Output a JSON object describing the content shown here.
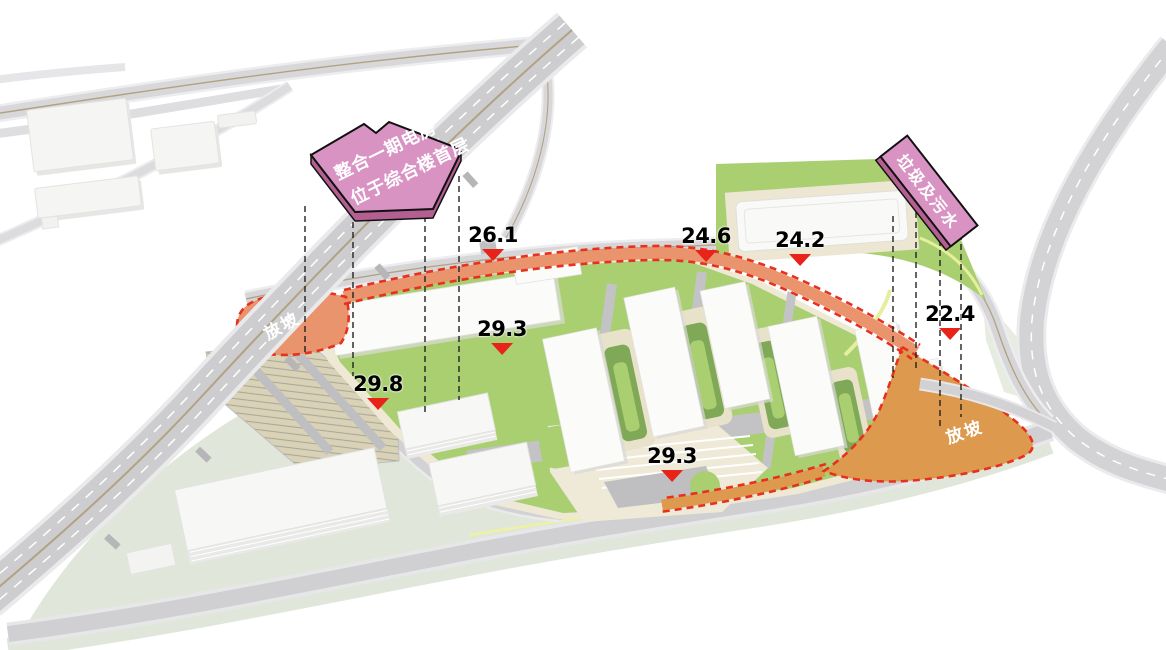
{
  "callouts": {
    "power_room": {
      "line1": "整合一期电房",
      "line2": "位于综合楼首层"
    },
    "waste": {
      "label": "垃圾及污水"
    }
  },
  "slope": {
    "west": "放坡",
    "east": "放坡"
  },
  "markers": [
    {
      "value": "26.1"
    },
    {
      "value": "24.6"
    },
    {
      "value": "24.2"
    },
    {
      "value": "29.3"
    },
    {
      "value": "29.8"
    },
    {
      "value": "22.4"
    },
    {
      "value": "29.3"
    }
  ],
  "colors": {
    "site_green": "#a9cf71",
    "courtyard_dark_green": "#7fa857",
    "slope_orange_west": "#e9946c",
    "slope_orange_east": "#dd9a4f",
    "boundary_red": "#e8301f",
    "callout_pink": "#d993c3",
    "callout_pink_side": "#b45f92",
    "marker_red": "#e8231a",
    "road_gray": "#d6d6d8",
    "ground_sage": "#e0e7da",
    "building_white": "#fbfbfa",
    "pad_beige": "#eee8d5"
  }
}
